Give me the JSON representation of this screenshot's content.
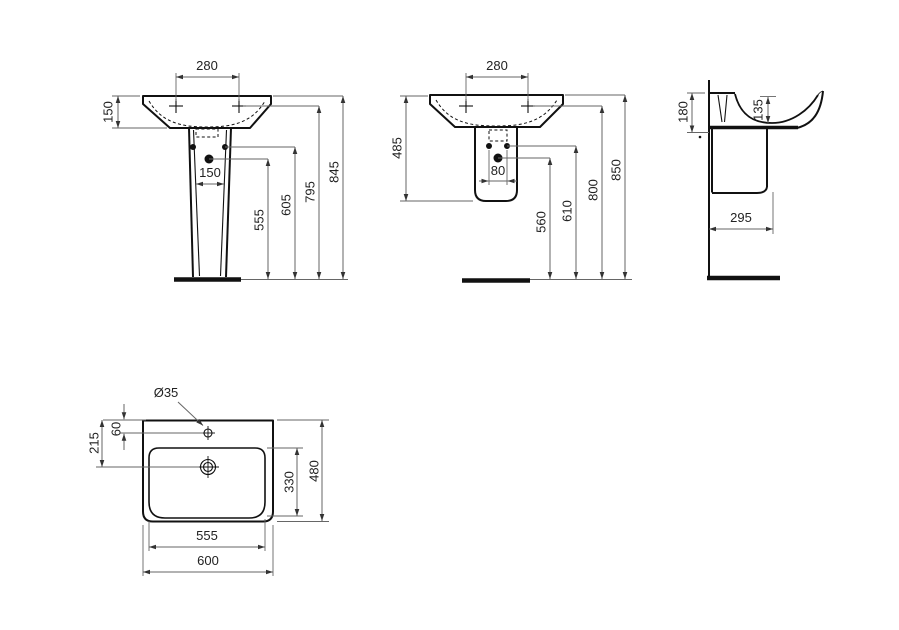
{
  "views": {
    "front_pedestal": {
      "dims": {
        "tap_spacing": "280",
        "basin_height": "150",
        "pedestal_width": "150",
        "drain_height": "555",
        "fixing_height": "605",
        "tap_height": "795",
        "rim_height": "845"
      }
    },
    "front_semi_pedestal": {
      "dims": {
        "tap_spacing": "280",
        "unit_height": "485",
        "fixing_spacing": "80",
        "drain_height": "560",
        "fixing_height": "610",
        "tap_height": "800",
        "rim_height": "850"
      }
    },
    "side": {
      "dims": {
        "back_height": "180",
        "bowl_depth": "135",
        "projection": "295"
      }
    },
    "top": {
      "dims": {
        "tap_hole_diameter": "Ø35",
        "tap_hole_offset": "60",
        "drain_offset": "215",
        "bowl_depth": "330",
        "overall_depth": "480",
        "bowl_width": "555",
        "overall_width": "600"
      }
    }
  },
  "colors": {
    "object_line": "#111111",
    "dimension_line": "#666666",
    "arrow": "#333333",
    "text": "#222222",
    "background": "#ffffff"
  }
}
